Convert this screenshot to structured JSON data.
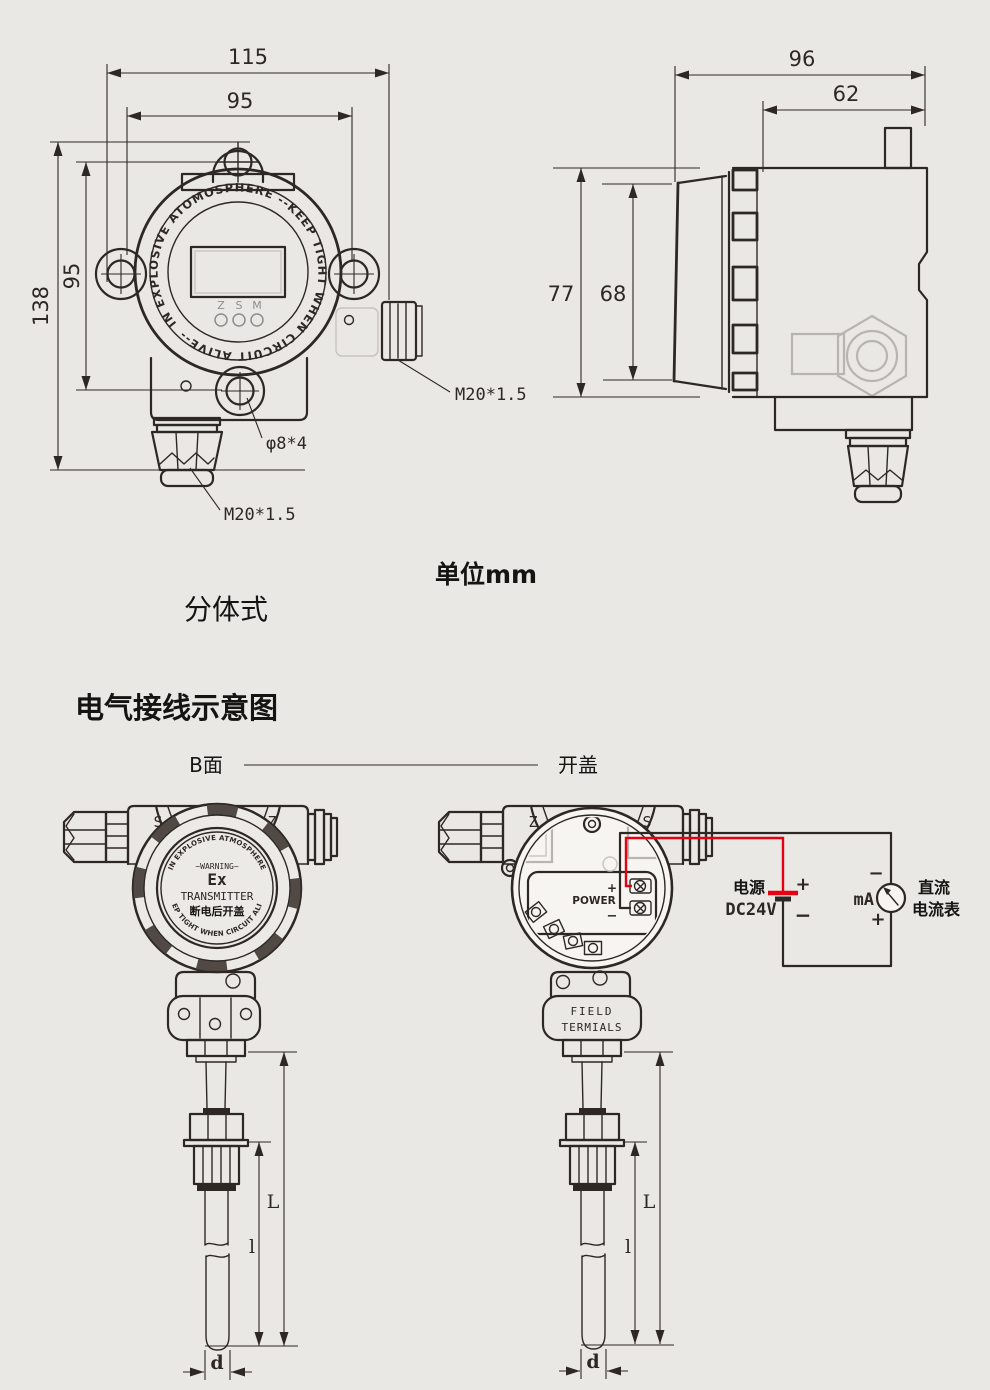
{
  "captions": {
    "unit": "单位mm",
    "split_type": "分体式",
    "wiring_title": "电气接线示意图",
    "side_b": "B面",
    "open_cover": "开盖"
  },
  "front_view": {
    "dim_w_outer": "115",
    "dim_w_inner": "95",
    "dim_h_outer": "138",
    "dim_h_inner": "95",
    "ring_text": "IN EXPLOSIVE ATOMOSPHERE --KEEP TIGHT WHEN CIRCUIT ALIVE--",
    "buttons": [
      "Z",
      "S",
      "M"
    ],
    "conduit_side_label": "M20*1.5",
    "mount_holes_label": "φ8*4",
    "conduit_bottom_label": "M20*1.5"
  },
  "side_view": {
    "dim_w_outer": "96",
    "dim_w_inner": "62",
    "dim_h_outer": "77",
    "dim_h_inner": "68"
  },
  "closed_unit": {
    "mark_left": "S",
    "mark_right": "Z",
    "arc_top": "-IN EXPLOSIVE ATMOSPHERE-",
    "warning": "~WARNING~",
    "ex_mark": "Ex",
    "device": "TRANSMITTER",
    "open_warning_cn": "断电后开盖",
    "arc_bottom": "-KEEP TIGHT WHEN CIRCUIT ALIVE-"
  },
  "open_unit": {
    "mark_left": "Z",
    "mark_right": "S",
    "power": "POWER",
    "plus": "+",
    "minus": "−",
    "terminals_line1": "FIELD",
    "terminals_line2": "TERMIALS"
  },
  "probe_dims": {
    "total_length": "L",
    "insert_length": "l",
    "diameter": "d"
  },
  "circuit": {
    "supply": "电源",
    "voltage": "DC24V",
    "supply_plus": "+",
    "supply_minus": "−",
    "meter_unit": "mA",
    "meter_minus": "−",
    "meter_plus": "+",
    "meter_line1": "直流",
    "meter_line2": "电流表"
  }
}
